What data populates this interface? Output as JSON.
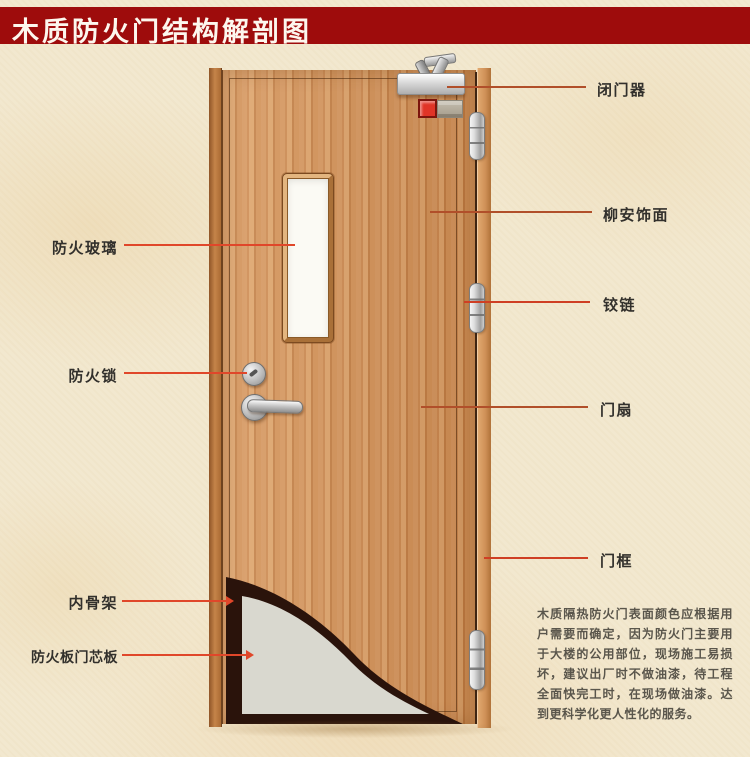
{
  "title": "木质防火门结构解剖图",
  "annotations": {
    "left": [
      {
        "label": "防火玻璃"
      },
      {
        "label": "防火锁"
      },
      {
        "label": "内骨架"
      },
      {
        "label": "防火板门芯板"
      }
    ],
    "right": [
      {
        "label": "闭门器"
      },
      {
        "label": "柳安饰面"
      },
      {
        "label": "铰链"
      },
      {
        "label": "门扇"
      },
      {
        "label": "门框"
      }
    ]
  },
  "description": "木质隔热防火门表面颜色应根据用户需要而确定，因为防火门主要用于大楼的公用部位，现场施工易损坏，建议出厂时不做油漆，待工程全面快完工时，在现场做油漆。达到更科学化更人性化的服务。",
  "colors": {
    "banner_red": "#9e0c0c",
    "background_cream": "#f2e8cf",
    "wood_base": "#d2915a",
    "leader_line_left": "#e0472a",
    "leader_line_right": "#b14f2a",
    "skeleton_dark": "#2a130b",
    "core_gray": "#d9d8cf",
    "glass_white": "#fbfaf4"
  }
}
